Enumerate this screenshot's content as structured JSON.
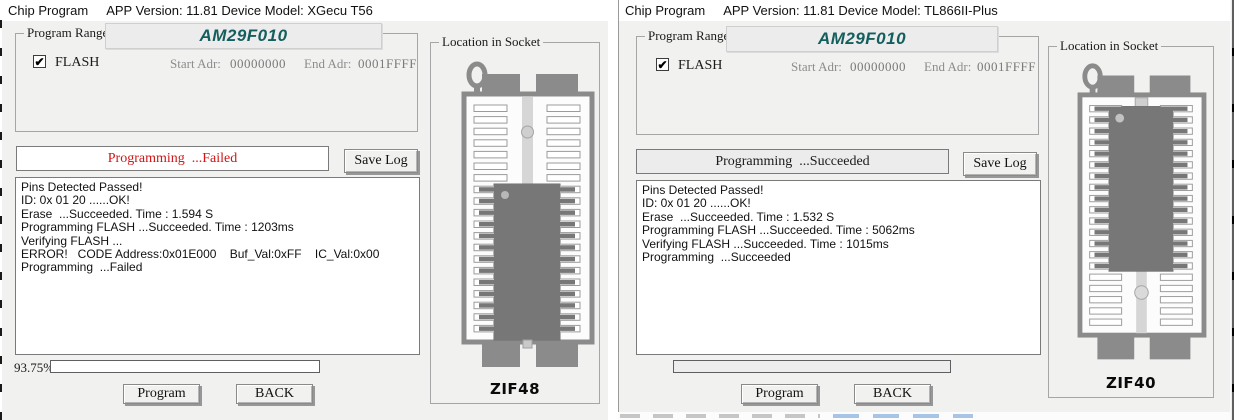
{
  "colors": {
    "chip_name_teal": "#155e5e",
    "status_fail_red": "#d01616",
    "status_ok_black": "#1a1a1a",
    "window_bg": "#f1f1f0"
  },
  "windows": [
    {
      "title": "Chip Program",
      "app_info": "APP Version: 11.81 Device Model: XGecu T56",
      "program_range": {
        "legend": "Program Range",
        "chip_name": "AM29F010",
        "flash_label": "FLASH",
        "flash_checked": true,
        "start_label": "Start Adr:",
        "start_value": "00000000",
        "end_label": "End Adr:",
        "end_value": "0001FFFF"
      },
      "status": {
        "text": "Programming  ...Failed",
        "color": "#d01616",
        "bg": "#ffffff"
      },
      "save_log_label": "Save Log",
      "log_lines": [
        "Pins Detected Passed!",
        "ID: 0x 01 20 ......OK!",
        "Erase  ...Succeeded. Time : 1.594 S",
        "Programming FLASH ...Succeeded. Time : 1203ms",
        "Verifying FLASH ...",
        "ERROR!   CODE Address:0x01E000    Buf_Val:0xFF    IC_Val:0x00",
        "Programming  ...Failed"
      ],
      "progress": {
        "label": "93.75%",
        "bar_fill": "#ffffff"
      },
      "buttons": {
        "program": "Program",
        "back": "BACK"
      },
      "socket": {
        "legend": "Location in Socket",
        "zif_label": "ZIF48",
        "chip_position": "bottom"
      }
    },
    {
      "title": "Chip Program",
      "app_info": "APP Version: 11.81 Device Model: TL866II-Plus",
      "program_range": {
        "legend": "Program Range",
        "chip_name": "AM29F010",
        "flash_label": "FLASH",
        "flash_checked": true,
        "start_label": "Start Adr:",
        "start_value": "00000000",
        "end_label": "End Adr:",
        "end_value": "0001FFFF"
      },
      "status": {
        "text": "Programming  ...Succeeded",
        "color": "#1a1a1a",
        "bg": "#ececec"
      },
      "save_log_label": "Save Log",
      "log_lines": [
        "Pins Detected Passed!",
        "ID: 0x 01 20 ......OK!",
        "Erase  ...Succeeded. Time : 1.532 S",
        "Programming FLASH ...Succeeded. Time : 5062ms",
        "Verifying FLASH ...Succeeded. Time : 1015ms",
        "Programming  ...Succeeded"
      ],
      "progress": {
        "label": "",
        "bar_fill": "#ededed"
      },
      "buttons": {
        "program": "Program",
        "back": "BACK"
      },
      "socket": {
        "legend": "Location in Socket",
        "zif_label": "ZIF40",
        "chip_position": "top"
      }
    }
  ]
}
